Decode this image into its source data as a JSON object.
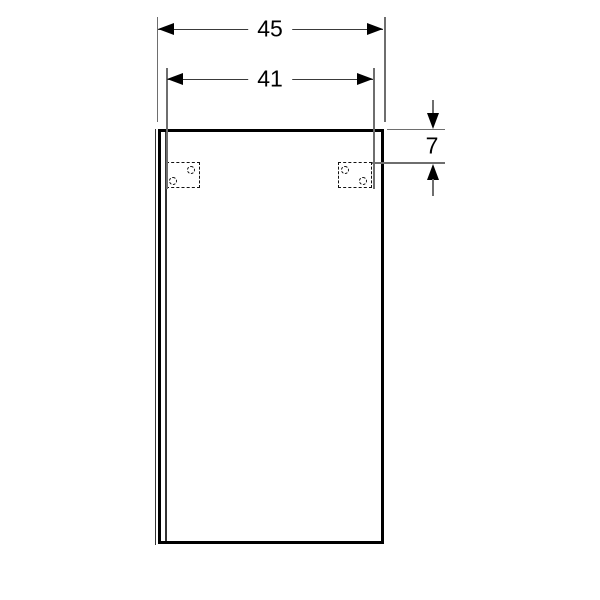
{
  "drawing": {
    "dimensions": {
      "total_width": {
        "label": "45"
      },
      "fixing_width": {
        "label": "41"
      },
      "top_offset": {
        "label": "7"
      }
    },
    "colors": {
      "outline": "#000000",
      "thin_line": "#6e6e6e",
      "background": "#ffffff"
    }
  }
}
